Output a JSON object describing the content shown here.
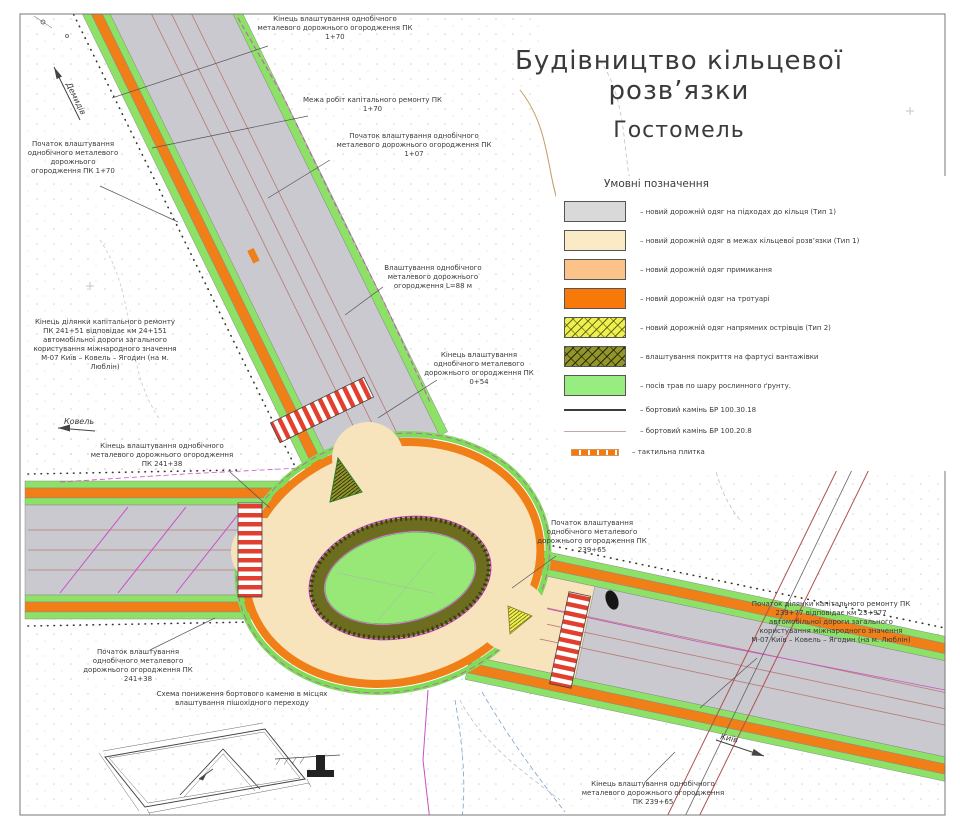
{
  "title": {
    "line1": "Будівництво кільцевої розв’язки",
    "line2": "Гостомель"
  },
  "legend": {
    "heading": "Умовні позначення",
    "items": [
      {
        "swatch": "gray",
        "label": "– новий дорожній одяг на підходах до кільця (Тип 1)"
      },
      {
        "swatch": "cream",
        "label": "– новий дорожній одяг в межах кільцевої розв’язки (Тип 1)"
      },
      {
        "swatch": "peach",
        "label": "– новий дорожній одяг примикання"
      },
      {
        "swatch": "orange",
        "label": "– новий дорожній одяг на тротуарі"
      },
      {
        "swatch": "hatch-yellow",
        "label": "– новий дорожній одяг напрямних острівців (Тип 2)"
      },
      {
        "swatch": "hatch-olive",
        "label": "– влаштування покриття на фартусі вантажівки"
      },
      {
        "swatch": "green",
        "label": "– посів трав по шару рослинного ґрунту."
      },
      {
        "swatch": "line-dark",
        "label": "– бортовий камінь БР 100.30.18"
      },
      {
        "swatch": "line-light",
        "label": "– бортовий камінь БР 100.20.8"
      },
      {
        "swatch": "tactile",
        "label": "– тактильна плитка"
      }
    ]
  },
  "callouts": {
    "end_guardrail_pk170": "Кінець влаштування однобічного металевого дорожнього огородження ПК 1+70",
    "work_limit_pk170": "Межа робіт капітального ремонту ПК 1+70",
    "start_guardrail_pk107": "Початок влаштування однобічного металевого дорожнього огородження ПК 1+07",
    "start_guardrail_pk170": "Початок влаштування однобічного металевого дорожнього огородження ПК 1+70",
    "end_section_pk24151": "Кінець ділянки капітального ремонту ПК 241+51 відповідає км 24+151 автомобільної дороги загального користування міжнародного значення М-07 Київ – Ковель – Ягодин (на м. Люблін)",
    "guardrail_l88": "Влаштування однобічного металевого дорожнього огородження L=88 м",
    "end_guardrail_pk054": "Кінець влаштування однобічного металевого дорожнього огородження ПК 0+54",
    "end_guardrail_pk24138": "Кінець влаштування однобічного металевого дорожнього огородження ПК 241+38",
    "start_guardrail_pk24138": "Початок влаштування однобічного металевого дорожнього огородження ПК 241+38",
    "start_guardrail_pk23965": "Початок влаштування однобічного металевого дорожнього огородження ПК 239+65",
    "start_section_pk23977": "Початок ділянки капітального ремонту ПК 239+77 відповідає км 23+977 автомобільної дороги загального користування міжнародного значення М-07 Київ – Ковель – Ягодин (на м. Люблін)",
    "end_guardrail_pk23965": "Кінець влаштування однобічного металевого дорожнього огородження ПК 239+65",
    "curb_scheme": "Схема пониження бортового каменю в місцях влаштування пішохідного переходу"
  },
  "direction_arrows": {
    "northwest": "Демидів",
    "west": "Ковель",
    "east": "Київ"
  },
  "colors": {
    "road_gray": "#c9c9cf",
    "ring_cream": "#f7e3bc",
    "junction_peach": "#fbc289",
    "sidewalk_orange": "#f07f17",
    "grass_green": "#8ce166",
    "island_green": "#98e878",
    "apron_olive": "#6d6d1f",
    "marking_magenta": "#c94fc9",
    "zebra_red": "#e2402e"
  }
}
